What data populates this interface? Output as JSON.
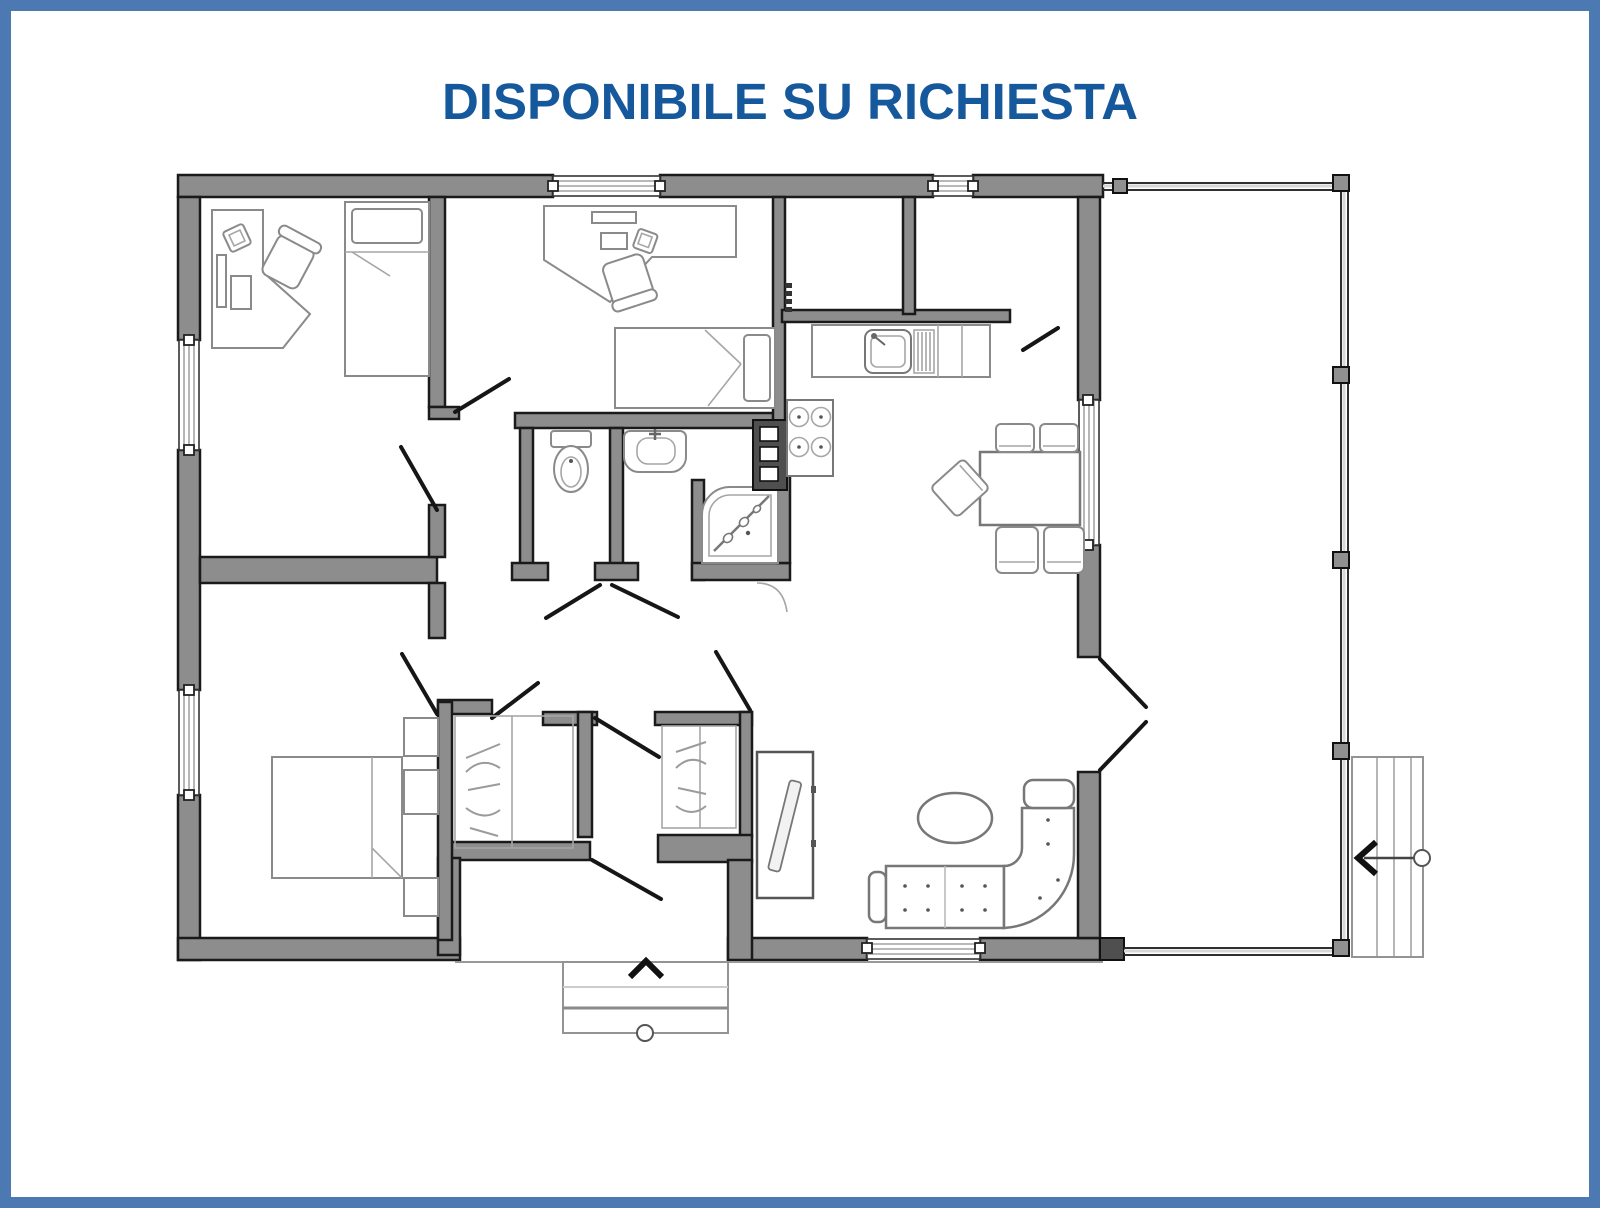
{
  "page": {
    "title": "DISPONIBILE SU RICHIESTA",
    "background": "#ffffff"
  },
  "colors": {
    "frame_border": "#4d79b3",
    "title_text": "#15599c",
    "wall_fill": "#8d8d8d",
    "wall_outline": "#1a1a1a",
    "furniture_line": "#8a8a8a"
  },
  "floor_plan": {
    "type": "apartment-floor-plan",
    "symbols": [
      "corner-desk",
      "office-chair",
      "single-bed",
      "single-bed",
      "double-bed",
      "nightstand",
      "wardrobe-hangers",
      "wardrobe-hangers",
      "toilet",
      "washbasin",
      "shower-cabin",
      "boiler-column",
      "kitchen-sink-counter",
      "stove-4-burners",
      "dining-table",
      "dining-chair",
      "sofa-sectional",
      "coffee-table-oval",
      "tv-cabinet",
      "porch-posts",
      "exterior-stairs",
      "entry-steps"
    ],
    "arrows": {
      "entry_steps": "up",
      "porch_stairs": "left"
    }
  }
}
